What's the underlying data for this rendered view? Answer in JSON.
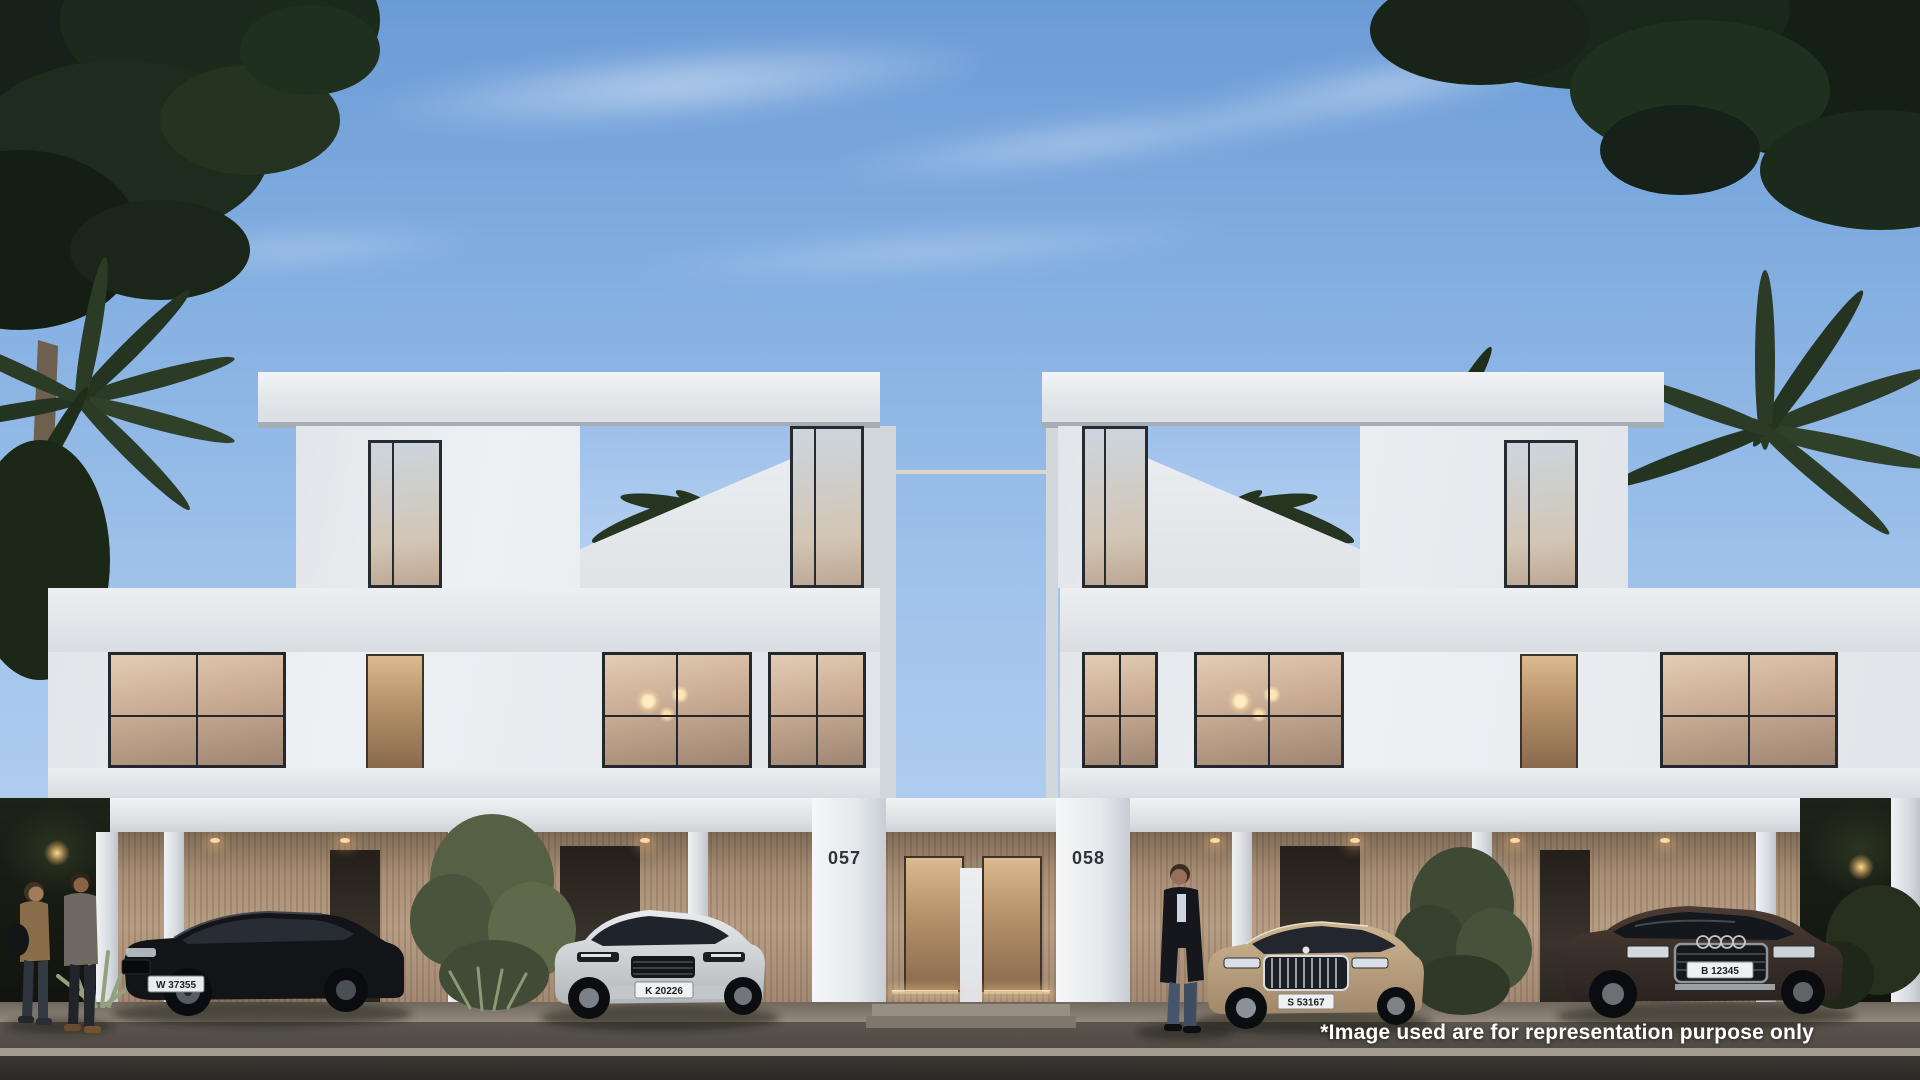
{
  "scene": {
    "disclaimer": "*Image used are for representation purpose only",
    "unit_left": "057",
    "unit_right": "058",
    "plates": {
      "black_sedan": "W 37355",
      "silver_suv": "K 20226",
      "champagne_sedan": "S 53167",
      "brown_suv": "B 12345"
    },
    "colors": {
      "sky_top": "#6b9bd6",
      "sky_bottom": "#c0d8f4",
      "facade_white": "#eef1f4",
      "travertine": "#b79d83",
      "foliage_dark": "#16211a",
      "road": "#2c2926",
      "car_black": "#15161a",
      "car_silver": "#d3d7da",
      "car_champagne": "#bba179",
      "car_brown": "#3a2f28"
    }
  }
}
